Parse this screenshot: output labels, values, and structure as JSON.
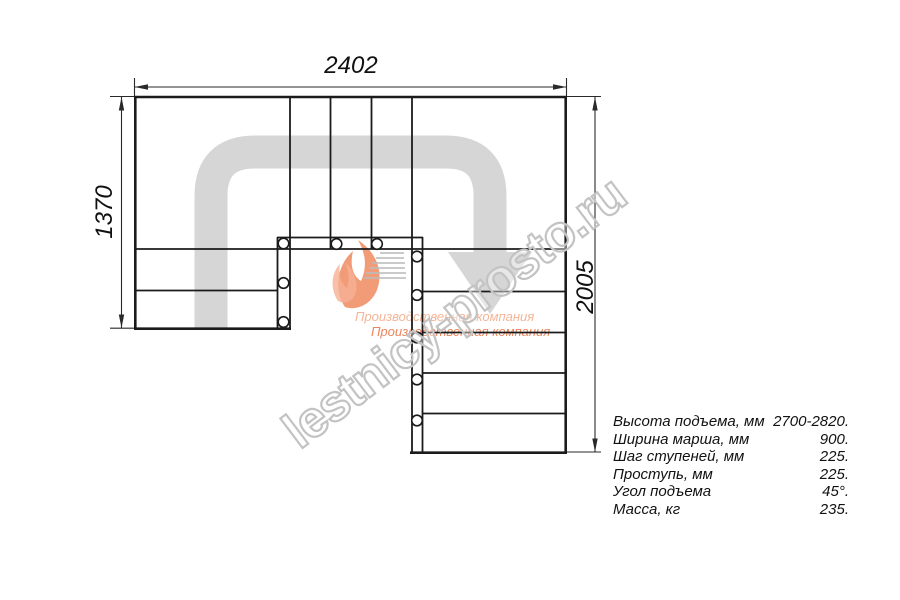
{
  "plan": {
    "dim_top": "2402",
    "dim_left": "1370",
    "dim_right": "2005"
  },
  "specs": {
    "rows": [
      {
        "label": "Высота подъема, мм",
        "value": "2700-2820."
      },
      {
        "label": "Ширина марша, мм",
        "value": "900."
      },
      {
        "label": "Шаг ступеней, мм",
        "value": "225."
      },
      {
        "label": "Проступь, мм",
        "value": "225."
      },
      {
        "label": "Угол подъема",
        "value": "45°."
      },
      {
        "label": "Масса, кг",
        "value": "235."
      }
    ]
  },
  "watermark": {
    "text": "lestnicy-prosto.ru",
    "tagline_line1": "Производственная компания",
    "tagline_line2": "Производственная компания"
  },
  "colors": {
    "line": "#1b1b1b",
    "dim_line": "#2a2a2a",
    "arrow_gray": "#d6d6d6",
    "watermark_gray": "#c3c3c3",
    "logo_orange": "#ee7a4a",
    "logo_orange_light": "#f6b094"
  }
}
